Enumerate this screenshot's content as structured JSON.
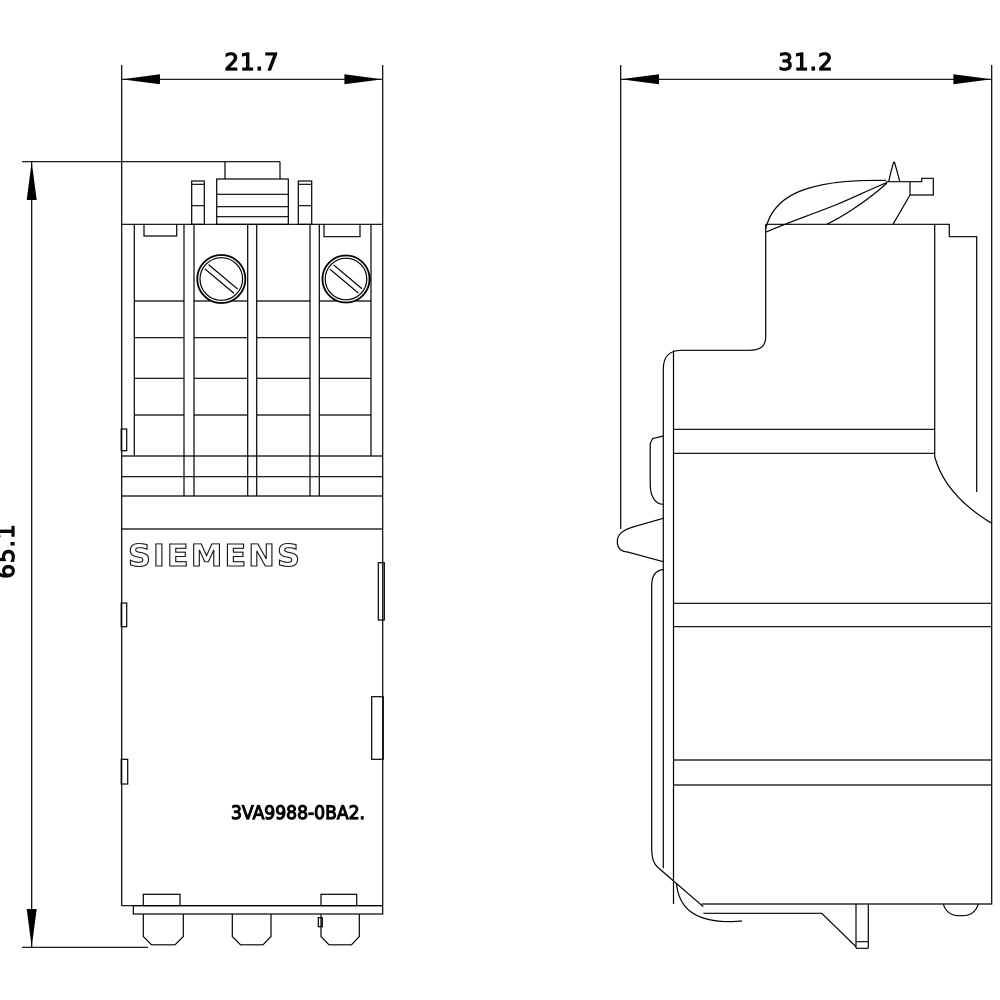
{
  "page": {
    "background_color": "#ffffff",
    "line_color": "#000000"
  },
  "drawing": {
    "brand_label": "SIEMENS",
    "part_number": "3VA9988-0BA2.",
    "dimensions": {
      "front_width_mm": "21.7",
      "side_depth_mm": "31.2",
      "height_mm": "65.1"
    },
    "views": {
      "front_view": "front view of accessory module with terminal screws and bottom plugs",
      "side_view": "side profile view with release lever and DIN-rail clip"
    },
    "icons": {
      "screw_left": "slotted-screw-icon",
      "screw_right": "slotted-screw-icon"
    }
  }
}
